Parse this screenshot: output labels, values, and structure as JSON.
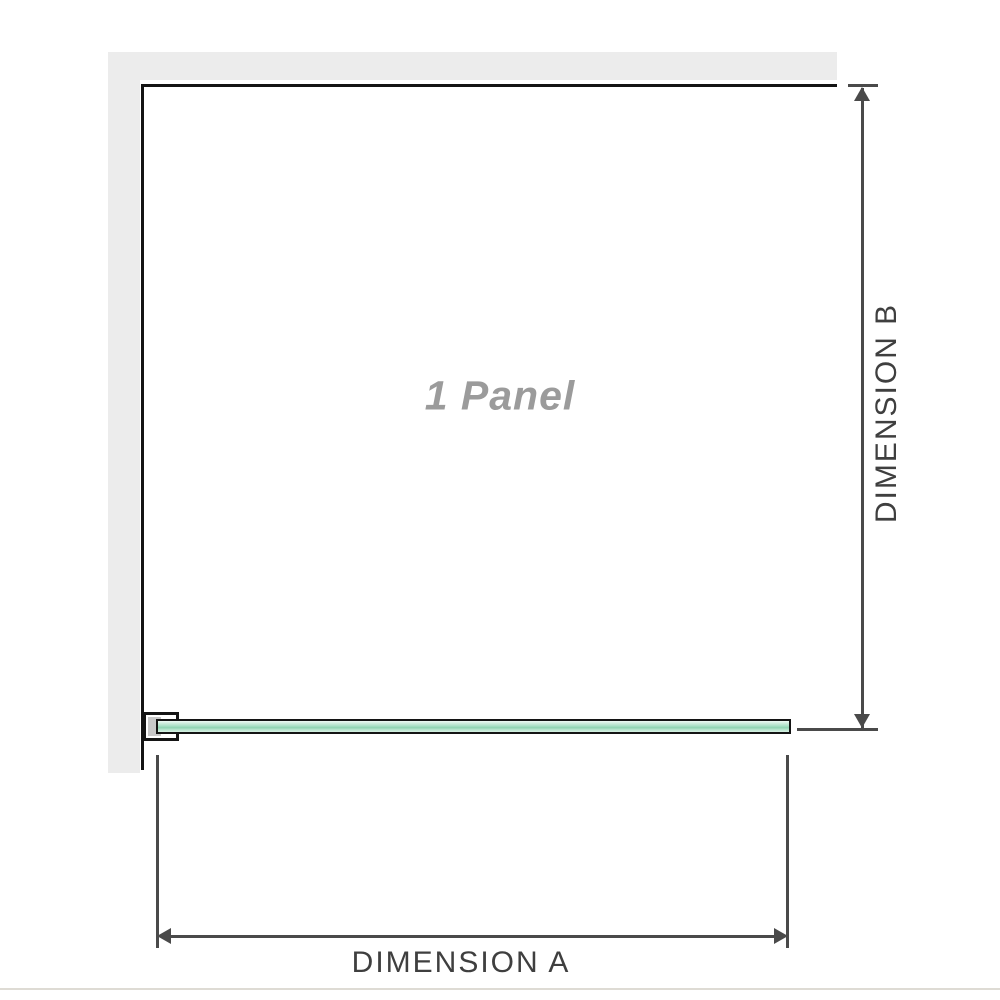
{
  "diagram": {
    "panel_label": "1 Panel",
    "dimension_a_label": "DIMENSION A",
    "dimension_b_label": "DIMENSION B"
  },
  "colors": {
    "wall_fill": "#ececec",
    "outline_black": "#141414",
    "arrow_gray": "#4a4a4a",
    "label_text": "#3f3f3f",
    "panel_text": "#9b9b9b",
    "glass_green_light": "#cdecdc",
    "glass_green_mid": "#8fd3b1",
    "bracket_fill": "#c8c8c8",
    "baseline_line": "#dedbd4"
  }
}
